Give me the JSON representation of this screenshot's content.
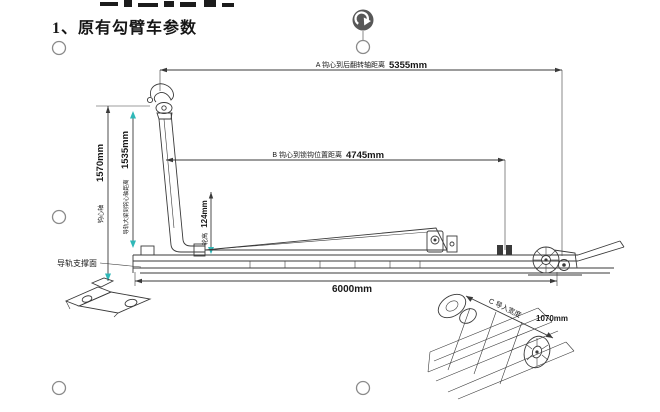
{
  "colors": {
    "accent_teal": "#2fb8b8",
    "line_dark": "#3a3a3a",
    "handle_gray": "#8a8a8a",
    "rotate_handle_bg": "#575757"
  },
  "heading": {
    "text": "1、原有勾臂车参数"
  },
  "drawing": {
    "dim_a_label": "A 钩心到后翻转轴距离",
    "dim_a_value": "5355mm",
    "dim_b_label": "B 钩心到锁钩位置距离",
    "dim_b_value": "4745mm",
    "dim_hook_height_label": "钩心轴",
    "dim_hook_height_value": "1570mm",
    "dim_rail_label": "导轨大梁到钩心轴距离",
    "dim_rail_value": "1535mm",
    "dim_roller_label": "轮高",
    "dim_roller_value": "124mm",
    "dim_length_value": "6000mm",
    "dim_c_label": "C 导入宽度",
    "dim_c_value": "1070mm",
    "callout_rail_support": "导轨支撑面"
  }
}
